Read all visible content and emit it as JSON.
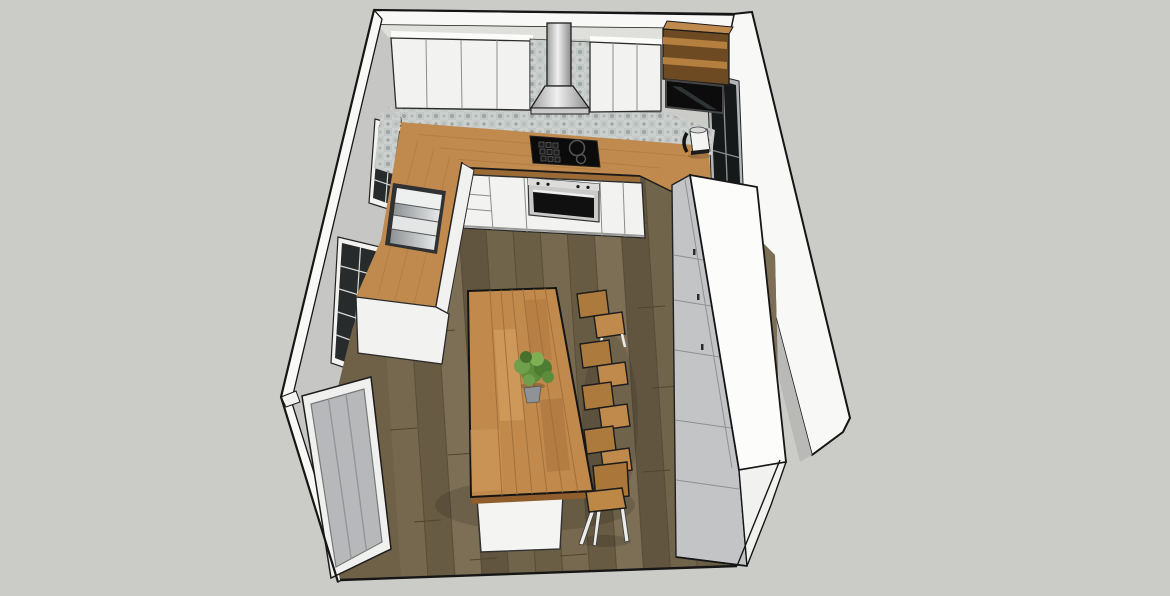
{
  "meta": {
    "description": "3D kitchen model render, SketchUp-like hidden-line style, bird's-eye view into a cutaway room",
    "visible_text": "none"
  },
  "palette": {
    "background": "#cbccc7",
    "wall_white": "#f8f8f6",
    "wall_gray": "#c6c7c5",
    "edge_black": "#161616",
    "floor_wood": "#6e6148",
    "floor_seam": "#554a36",
    "counter_wood": "#c08a4e",
    "island_wood": "#c18a4c",
    "cabinet_white": "#f2f2f0",
    "tile_gray": "#ccd0ce",
    "appliance_black": "#0b0b0b",
    "steel_light": "#e6e8e9",
    "steel_dark": "#8e9193",
    "unit_gray": "#c3c4c6",
    "unit_white": "#fcfcfb",
    "door_gray": "#b7b8ba",
    "stool_wood": "#c08a4c",
    "stool_back_wood": "#ad7a3e",
    "leg_white": "#ececea",
    "plant_green": "#5c8c3c",
    "pot_gray": "#8f9397"
  },
  "room": {
    "view": "top-down three-quarter",
    "open_side": "front cutaway, no wall",
    "floor": "dark oak plank flooring",
    "walls": [
      "back wall with upper cabinets",
      "left wall with two windows",
      "front-left stub wall with door",
      "right wall with dark window"
    ]
  },
  "kitchen": {
    "upper_cabinets": {
      "left_block_doors": 4,
      "right_block_doors": 3,
      "finish": "white handleless"
    },
    "range_hood": "stainless chimney hood with pyramid canopy",
    "backsplash": "gray patchwork patterned tile band",
    "open_shelves": 2,
    "wall_screen": "black flat panel in wood surround",
    "cooktop": {
      "type": "black hob",
      "zones_visible": 3
    },
    "oven": "built-in single oven, black glass with steel trim and knobs",
    "sink": "inset stainless multi-bowl module on left run",
    "kettle": "white electric kettle with black handle",
    "worktop": "oak butcher block",
    "base_cabinets": "white with drawer stack left of oven",
    "tall_unit": "white tall cabinet bank along right wall with gray paneled side",
    "island": {
      "top": "oak butcher block",
      "base": "white plinth",
      "decor": "green potted plant"
    },
    "seating": {
      "bar_stools": 4,
      "chairs": 1,
      "material": "wood seats and backs, white legs"
    }
  },
  "windows": {
    "left_wall": 2,
    "right_wall": 1,
    "style": "dark multi-pane grid"
  },
  "door": {
    "location": "front-left stub wall",
    "finish": "gray panel door, white frame"
  }
}
